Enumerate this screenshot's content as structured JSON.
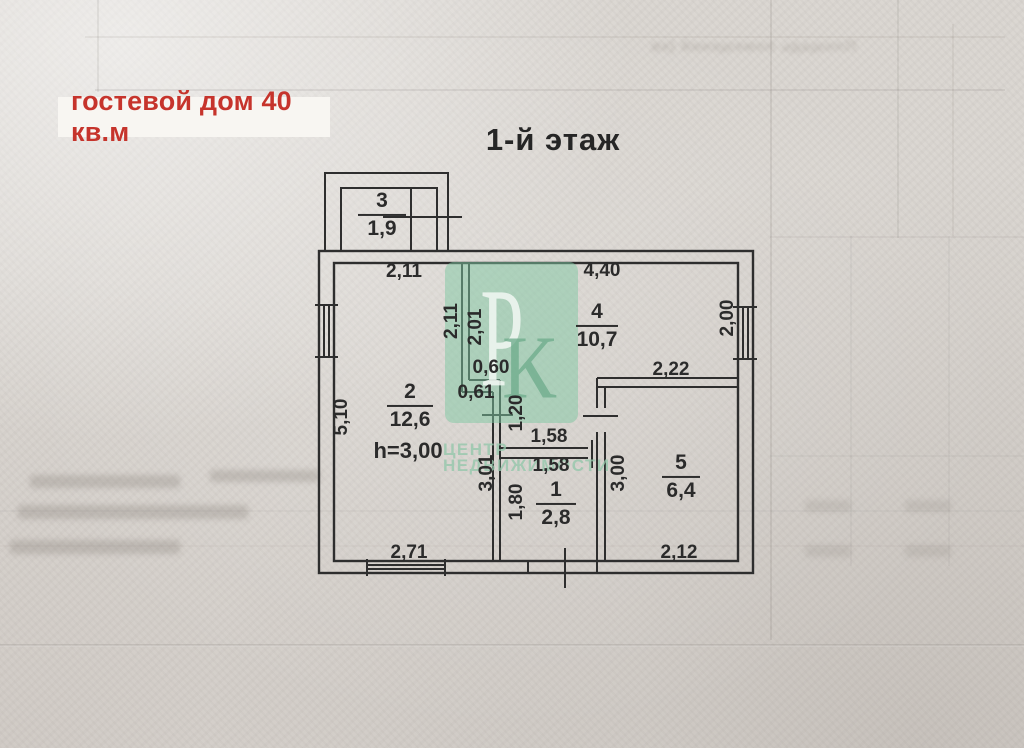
{
  "label_box": {
    "text": "гостевой дом 40 кв.м"
  },
  "title": "1-й этаж",
  "watermark": {
    "letter_p": "Р",
    "letter_k": "К",
    "line1": "ЦЕНТР",
    "line2": "НЕДВИЖИМОСТИ"
  },
  "rooms": {
    "r1": {
      "number": "1",
      "area": "2,8"
    },
    "r2": {
      "number": "2",
      "area": "12,6",
      "note": "h=3,00"
    },
    "r3": {
      "number": "3",
      "area": "1,9"
    },
    "r4": {
      "number": "4",
      "area": "10,7"
    },
    "r5": {
      "number": "5",
      "area": "6,4"
    }
  },
  "dimensions": {
    "room2_top": "2,11",
    "room4_top": "4,40",
    "hall_left_v": "2,11",
    "hall_right_v": "2,01",
    "step_top": "0,60",
    "step_bottom": "0,61",
    "hall_door_v": "1,20",
    "right_wall_v": "2,00",
    "room5_top": "2,22",
    "left_wall_v": "5,10",
    "room1_top_outer": "1,58",
    "room1_top_inner": "1,58",
    "hall_depth_v": "3,01",
    "room1_left_v": "1,80",
    "room5_left_v": "3,00",
    "room2_bottom": "2,71",
    "room5_bottom": "2,12"
  },
  "background": {
    "bleed_text": "Площадь помещений (кв"
  },
  "colors": {
    "red": "#c6342c",
    "ink": "#2e2e2e",
    "watermark_green": "#7dc8a2"
  }
}
